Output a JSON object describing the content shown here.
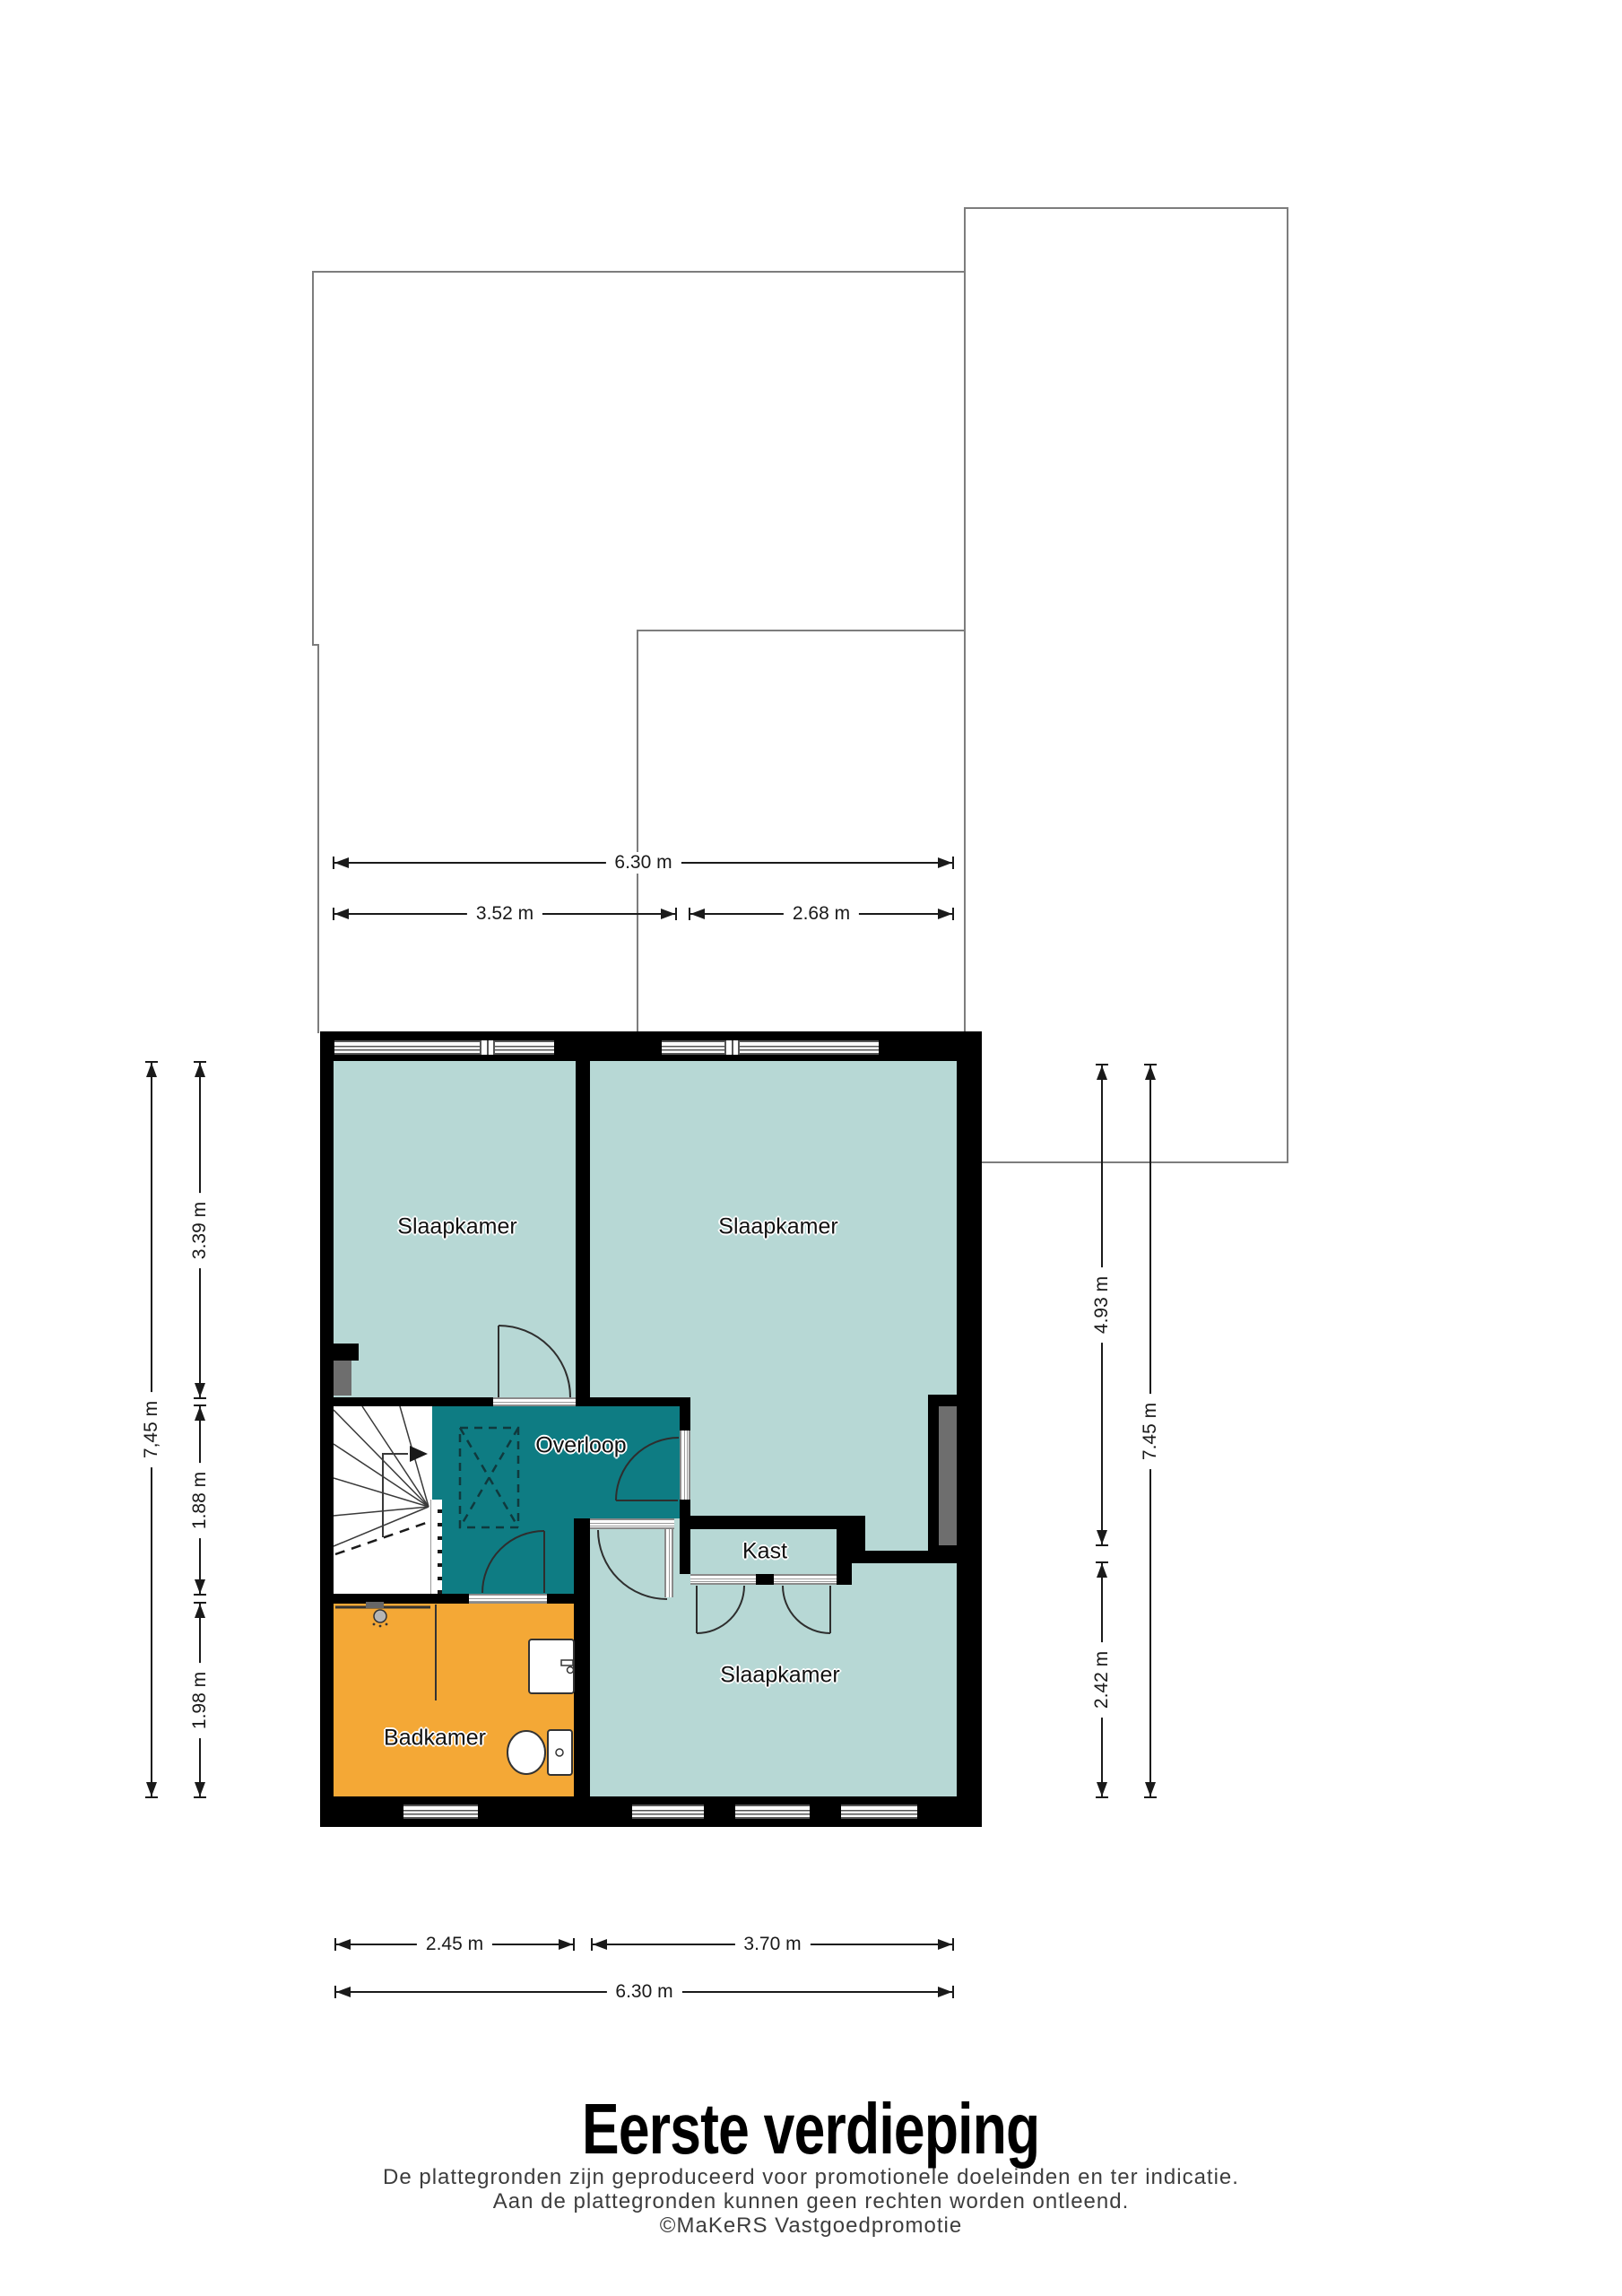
{
  "page": {
    "title": "Eerste verdieping",
    "disclaimer": [
      "De plattegronden zijn geproduceerd voor promotionele doeleinden en ter indicatie.",
      "Aan de plattegronden kunnen geen rechten worden ontleend.",
      "©MaKeRS Vastgoedpromotie"
    ]
  },
  "rooms": {
    "bedroom_top_left": "Slaapkamer",
    "bedroom_top_right": "Slaapkamer",
    "bedroom_bottom": "Slaapkamer",
    "landing": "Overloop",
    "closet": "Kast",
    "bathroom": "Badkamer"
  },
  "dimensions": {
    "top_total": "6.30 m",
    "top_left_span": "3.52 m",
    "top_right_span": "2.68 m",
    "left_total": "7,45 m",
    "left_upper": "3.39 m",
    "left_middle": "1.88 m",
    "left_lower": "1.98 m",
    "right_upper": "4.93 m",
    "right_lower": "2.42 m",
    "right_total": "7.45 m",
    "bottom_left_span": "2.45 m",
    "bottom_right_span": "3.70 m",
    "bottom_total": "6.30 m"
  },
  "colors": {
    "room_fill": "#b7d8d5",
    "landing_fill": "#0e7c83",
    "bathroom_fill": "#f4a836",
    "wall": "#000000",
    "roof_outline": "#7d7d7d",
    "fixture_gray": "#6e6e6e",
    "dimension_line": "#1a1a1a"
  },
  "icons": {
    "stairs": "stairs-icon",
    "toilet": "toilet-icon",
    "sink": "sink-icon",
    "shower": "shower-icon",
    "door_swing": "door-arc-icon"
  }
}
